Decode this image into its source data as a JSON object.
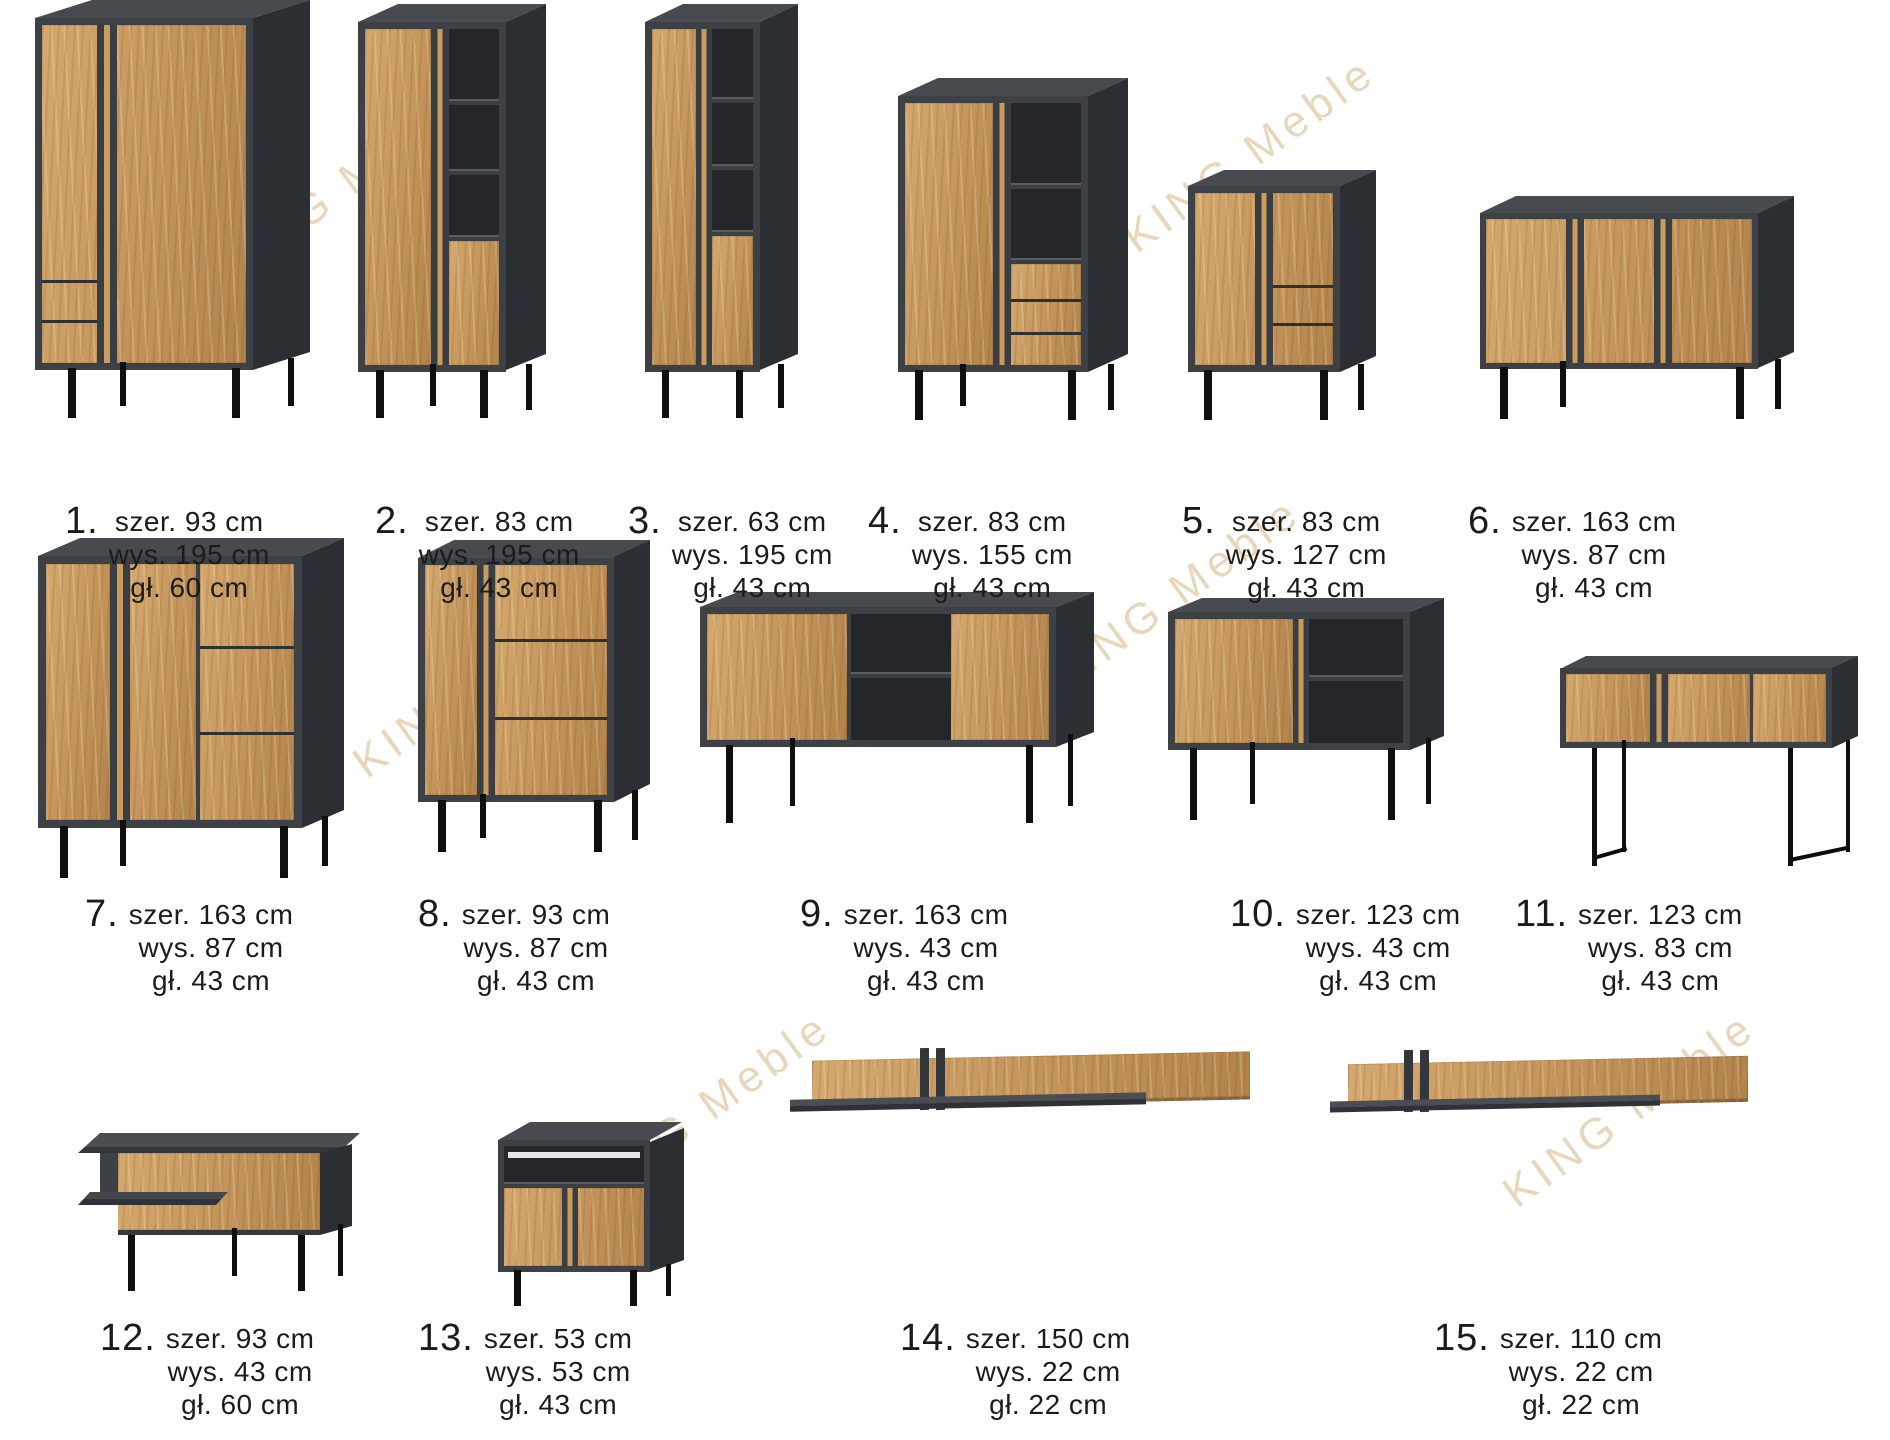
{
  "watermark": "KING Meble",
  "items": [
    {
      "num": "1.",
      "dims": [
        "szer. 93 cm",
        "wys. 195 cm",
        "gł. 60 cm"
      ]
    },
    {
      "num": "2.",
      "dims": [
        "szer. 83 cm",
        "wys. 195 cm",
        "gł. 43 cm"
      ]
    },
    {
      "num": "3.",
      "dims": [
        "szer. 63 cm",
        "wys. 195 cm",
        "gł. 43 cm"
      ]
    },
    {
      "num": "4.",
      "dims": [
        "szer. 83 cm",
        "wys. 155 cm",
        "gł. 43 cm"
      ]
    },
    {
      "num": "5.",
      "dims": [
        "szer. 83 cm",
        "wys. 127 cm",
        "gł. 43 cm"
      ]
    },
    {
      "num": "6.",
      "dims": [
        "szer. 163 cm",
        "wys. 87 cm",
        "gł. 43 cm"
      ]
    },
    {
      "num": "7.",
      "dims": [
        "szer. 163 cm",
        "wys. 87 cm",
        "gł. 43 cm"
      ]
    },
    {
      "num": "8.",
      "dims": [
        "szer. 93 cm",
        "wys. 87 cm",
        "gł. 43 cm"
      ]
    },
    {
      "num": "9.",
      "dims": [
        "szer. 163 cm",
        "wys. 43 cm",
        "gł. 43 cm"
      ]
    },
    {
      "num": "10.",
      "dims": [
        "szer. 123 cm",
        "wys. 43 cm",
        "gł. 43 cm"
      ]
    },
    {
      "num": "11.",
      "dims": [
        "szer. 123 cm",
        "wys. 83 cm",
        "gł. 43 cm"
      ]
    },
    {
      "num": "12.",
      "dims": [
        "szer. 93 cm",
        "wys. 43 cm",
        "gł. 60 cm"
      ]
    },
    {
      "num": "13.",
      "dims": [
        "szer. 53 cm",
        "wys. 53 cm",
        "gł. 43 cm"
      ]
    },
    {
      "num": "14.",
      "dims": [
        "szer. 150 cm",
        "wys. 22 cm",
        "gł. 22 cm"
      ]
    },
    {
      "num": "15.",
      "dims": [
        "szer. 110 cm",
        "wys. 22 cm",
        "gł. 22 cm"
      ]
    }
  ],
  "colors": {
    "graphite": "#3d4044",
    "graphite_dark": "#2b2e32",
    "oak": "#c3935a",
    "leg": "#0f0f0f",
    "watermark": "#c69d5a"
  }
}
